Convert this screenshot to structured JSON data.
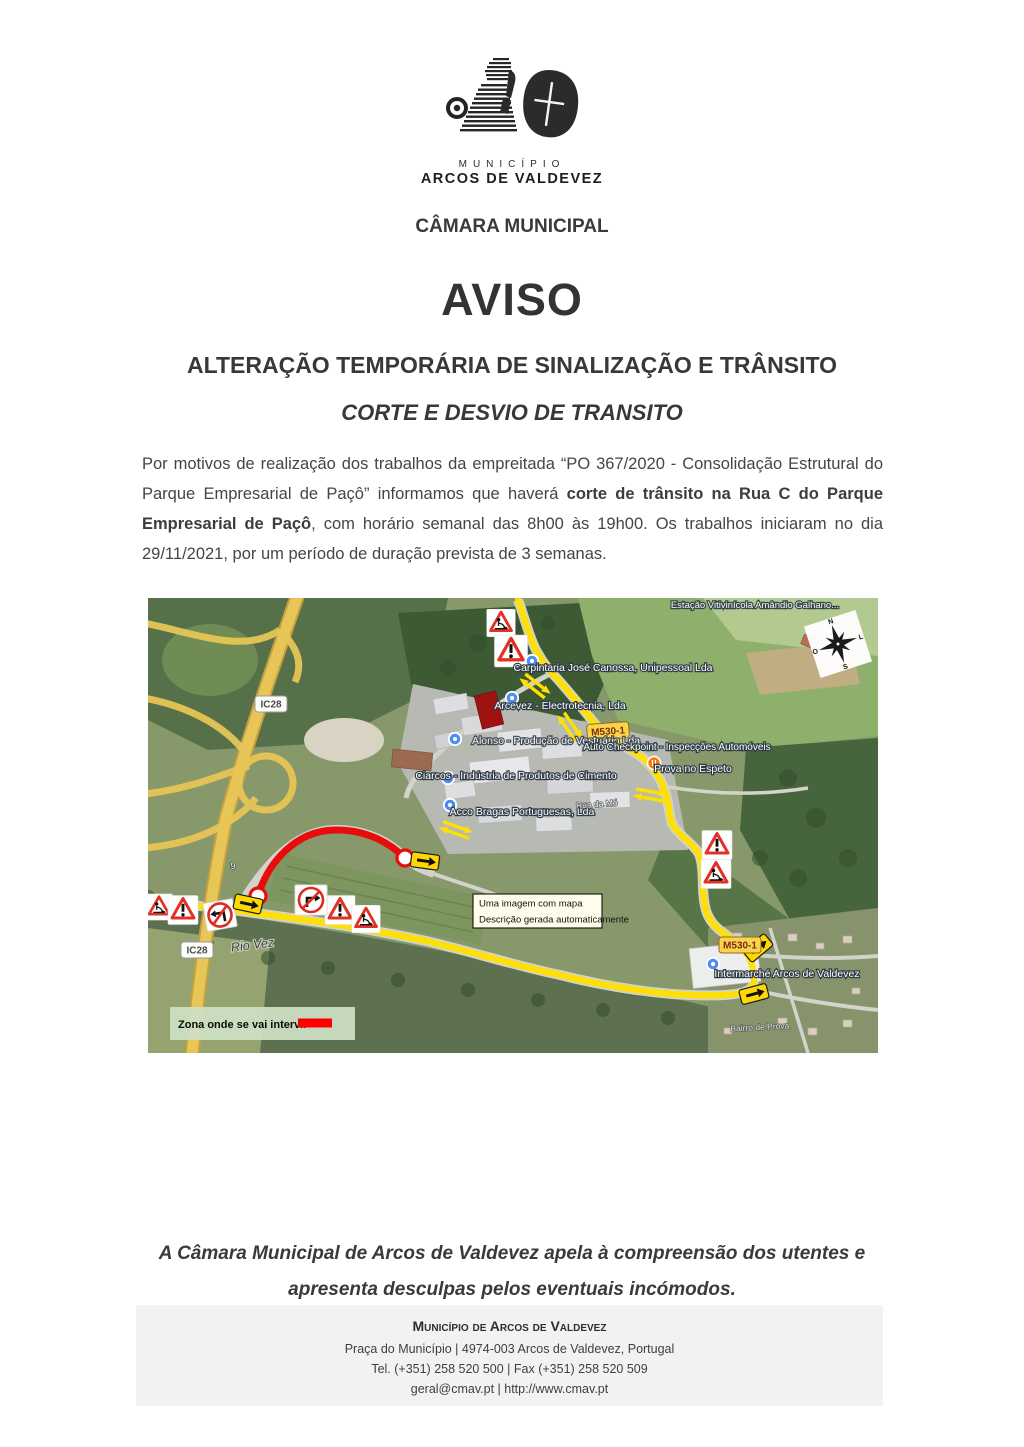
{
  "logo": {
    "municipality_word": "MUNICÍPIO",
    "municipality_name": "ARCOS DE VALDEVEZ"
  },
  "header": {
    "org_line": "CÂMARA MUNICIPAL",
    "title": "AVISO",
    "subtitle1": "ALTERAÇÃO TEMPORÁRIA DE SINALIZAÇÃO E TRÂNSITO",
    "subtitle2": "CORTE E DESVIO DE TRANSITO"
  },
  "body": {
    "paragraph_part1": "Por motivos de realização dos trabalhos da empreitada “PO 367/2020 - Consolidação Estrutural do Parque Empresarial de Paçô” informamos que haverá ",
    "paragraph_bold": "corte de trânsito na Rua C do Parque Empresarial de Paçô",
    "paragraph_part2": ", com horário semanal das 8h00 às 19h00. Os trabalhos iniciaram no dia 29/11/2021, por um período de duração prevista de 3 semanas."
  },
  "map": {
    "alt_box": {
      "line1": "Uma imagem com mapa",
      "line2": "Descrição gerada automaticamente"
    },
    "legend": {
      "label": "Zona onde se vai intervir",
      "swatch_color": "#fe0000"
    },
    "badges": {
      "ic28": "IC28",
      "m530": "M530-1"
    },
    "labels": {
      "estacao": "Estação Vitivinícola Amândio Galhano...",
      "carpintaria": "Carpintaria José Canossa, Unipessoal Lda",
      "arcevez": "Arcevez - Electrotecnia, Lda",
      "alonso": "Alonso - Produção de Vestuário Lda",
      "autocheck": "Auto Checkpoint - Inspecções Automóveis",
      "prova": "Prova no Espeto",
      "ciarcos": "Ciarcos - Indústria de Produtos de Cimento",
      "acco": "Acco Bragas Portuguesas, Lda",
      "intermarche": "Intermarché Arcos de Valdevez"
    },
    "street_labels": {
      "rio_vez": "Rio Vez",
      "rua_mo": "Rua da Mó",
      "bairro": "Bairro de Prova",
      "km": "9"
    },
    "compass": {
      "n": "N",
      "e": "L",
      "s": "S",
      "w": "O"
    },
    "colors": {
      "detour_route": "#ffdf00",
      "closed_road": "#e80c0c",
      "highway": "#e7c556"
    }
  },
  "closing": {
    "line1": "A Câmara Municipal de Arcos de Valdevez apela à compreensão dos utentes e",
    "line2": "apresenta desculpas pelos eventuais incómodos."
  },
  "footer": {
    "title": "Município de Arcos de Valdevez",
    "address": "Praça do Município | 4974-003  Arcos de Valdevez, Portugal",
    "phones": "Tel. (+351) 258 520 500 | Fax (+351) 258 520 509",
    "web": "geral@cmav.pt | http://www.cmav.pt"
  }
}
